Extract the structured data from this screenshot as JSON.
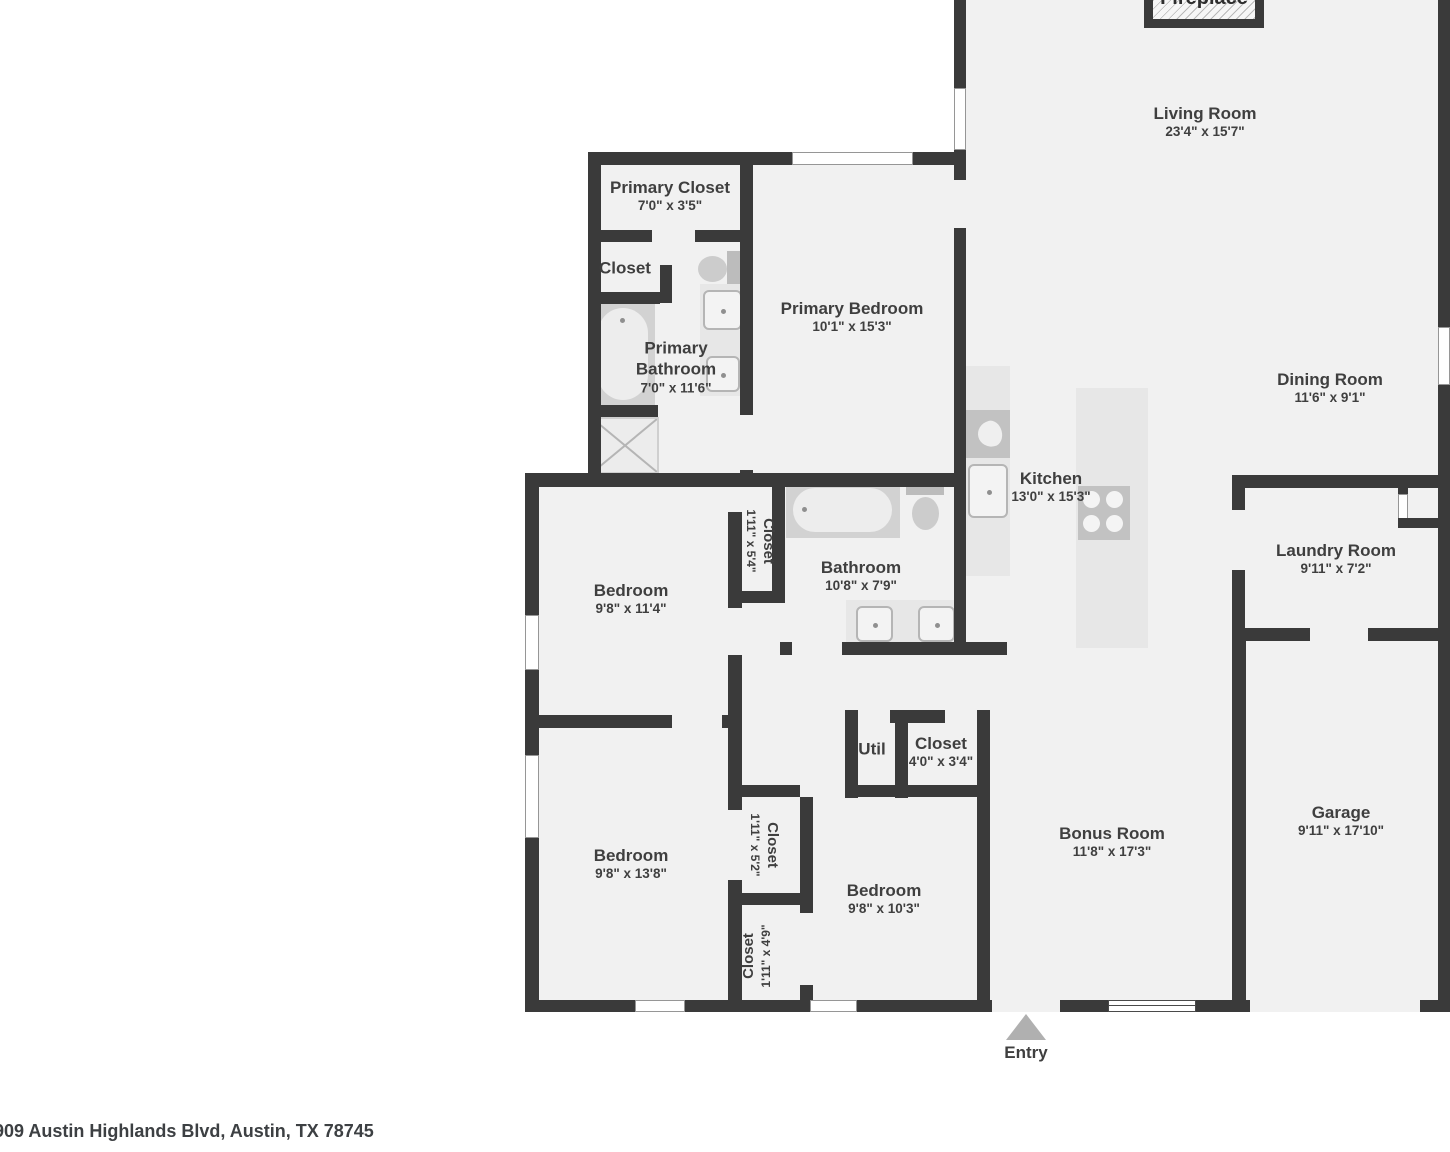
{
  "address": "909 Austin Highlands Blvd, Austin, TX 78745",
  "colors": {
    "wall": "#3a3a3a",
    "floor": "#f1f1f1",
    "counter": "#e7e7e7",
    "appliance": "#c2c2c2",
    "text": "#3f3f3f",
    "entry_arrow": "#b0b0b0"
  },
  "fireplace": {
    "label": "Fireplace"
  },
  "entry": {
    "label": "Entry"
  },
  "rooms": {
    "living": {
      "name": "Living Room",
      "dims": "23'4\" x 15'7\""
    },
    "dining": {
      "name": "Dining Room",
      "dims": "11'6\" x 9'1\""
    },
    "kitchen": {
      "name": "Kitchen",
      "dims": "13'0\" x 15'3\""
    },
    "primary_closet": {
      "name": "Primary Closet",
      "dims": "7'0\" x 3'5\""
    },
    "closet_ps": {
      "name": "Closet"
    },
    "primary_bathroom": {
      "name": "Primary Bathroom",
      "dims": "7'0\" x 11'6\""
    },
    "primary_bedroom": {
      "name": "Primary Bedroom",
      "dims": "10'1\" x 15'3\""
    },
    "bedroom1": {
      "name": "Bedroom",
      "dims": "9'8\" x 11'4\""
    },
    "closet_b1": {
      "name": "Closet",
      "dims": "1'11\" x 5'4\""
    },
    "bathroom": {
      "name": "Bathroom",
      "dims": "10'8\" x 7'9\""
    },
    "laundry": {
      "name": "Laundry Room",
      "dims": "9'11\" x 7'2\""
    },
    "bedroom2": {
      "name": "Bedroom",
      "dims": "9'8\" x 13'8\""
    },
    "closet_b2": {
      "name": "Closet",
      "dims": "1'11\" x 5'2\""
    },
    "closet_b3": {
      "name": "Closet",
      "dims": "1'11\" x 4'9\""
    },
    "util": {
      "name": "Util"
    },
    "closet_hall": {
      "name": "Closet",
      "dims": "4'0\" x 3'4\""
    },
    "bedroom3": {
      "name": "Bedroom",
      "dims": "9'8\" x 10'3\""
    },
    "bonus": {
      "name": "Bonus Room",
      "dims": "11'8\" x 17'3\""
    },
    "garage": {
      "name": "Garage",
      "dims": "9'11\" x 17'10\""
    }
  }
}
